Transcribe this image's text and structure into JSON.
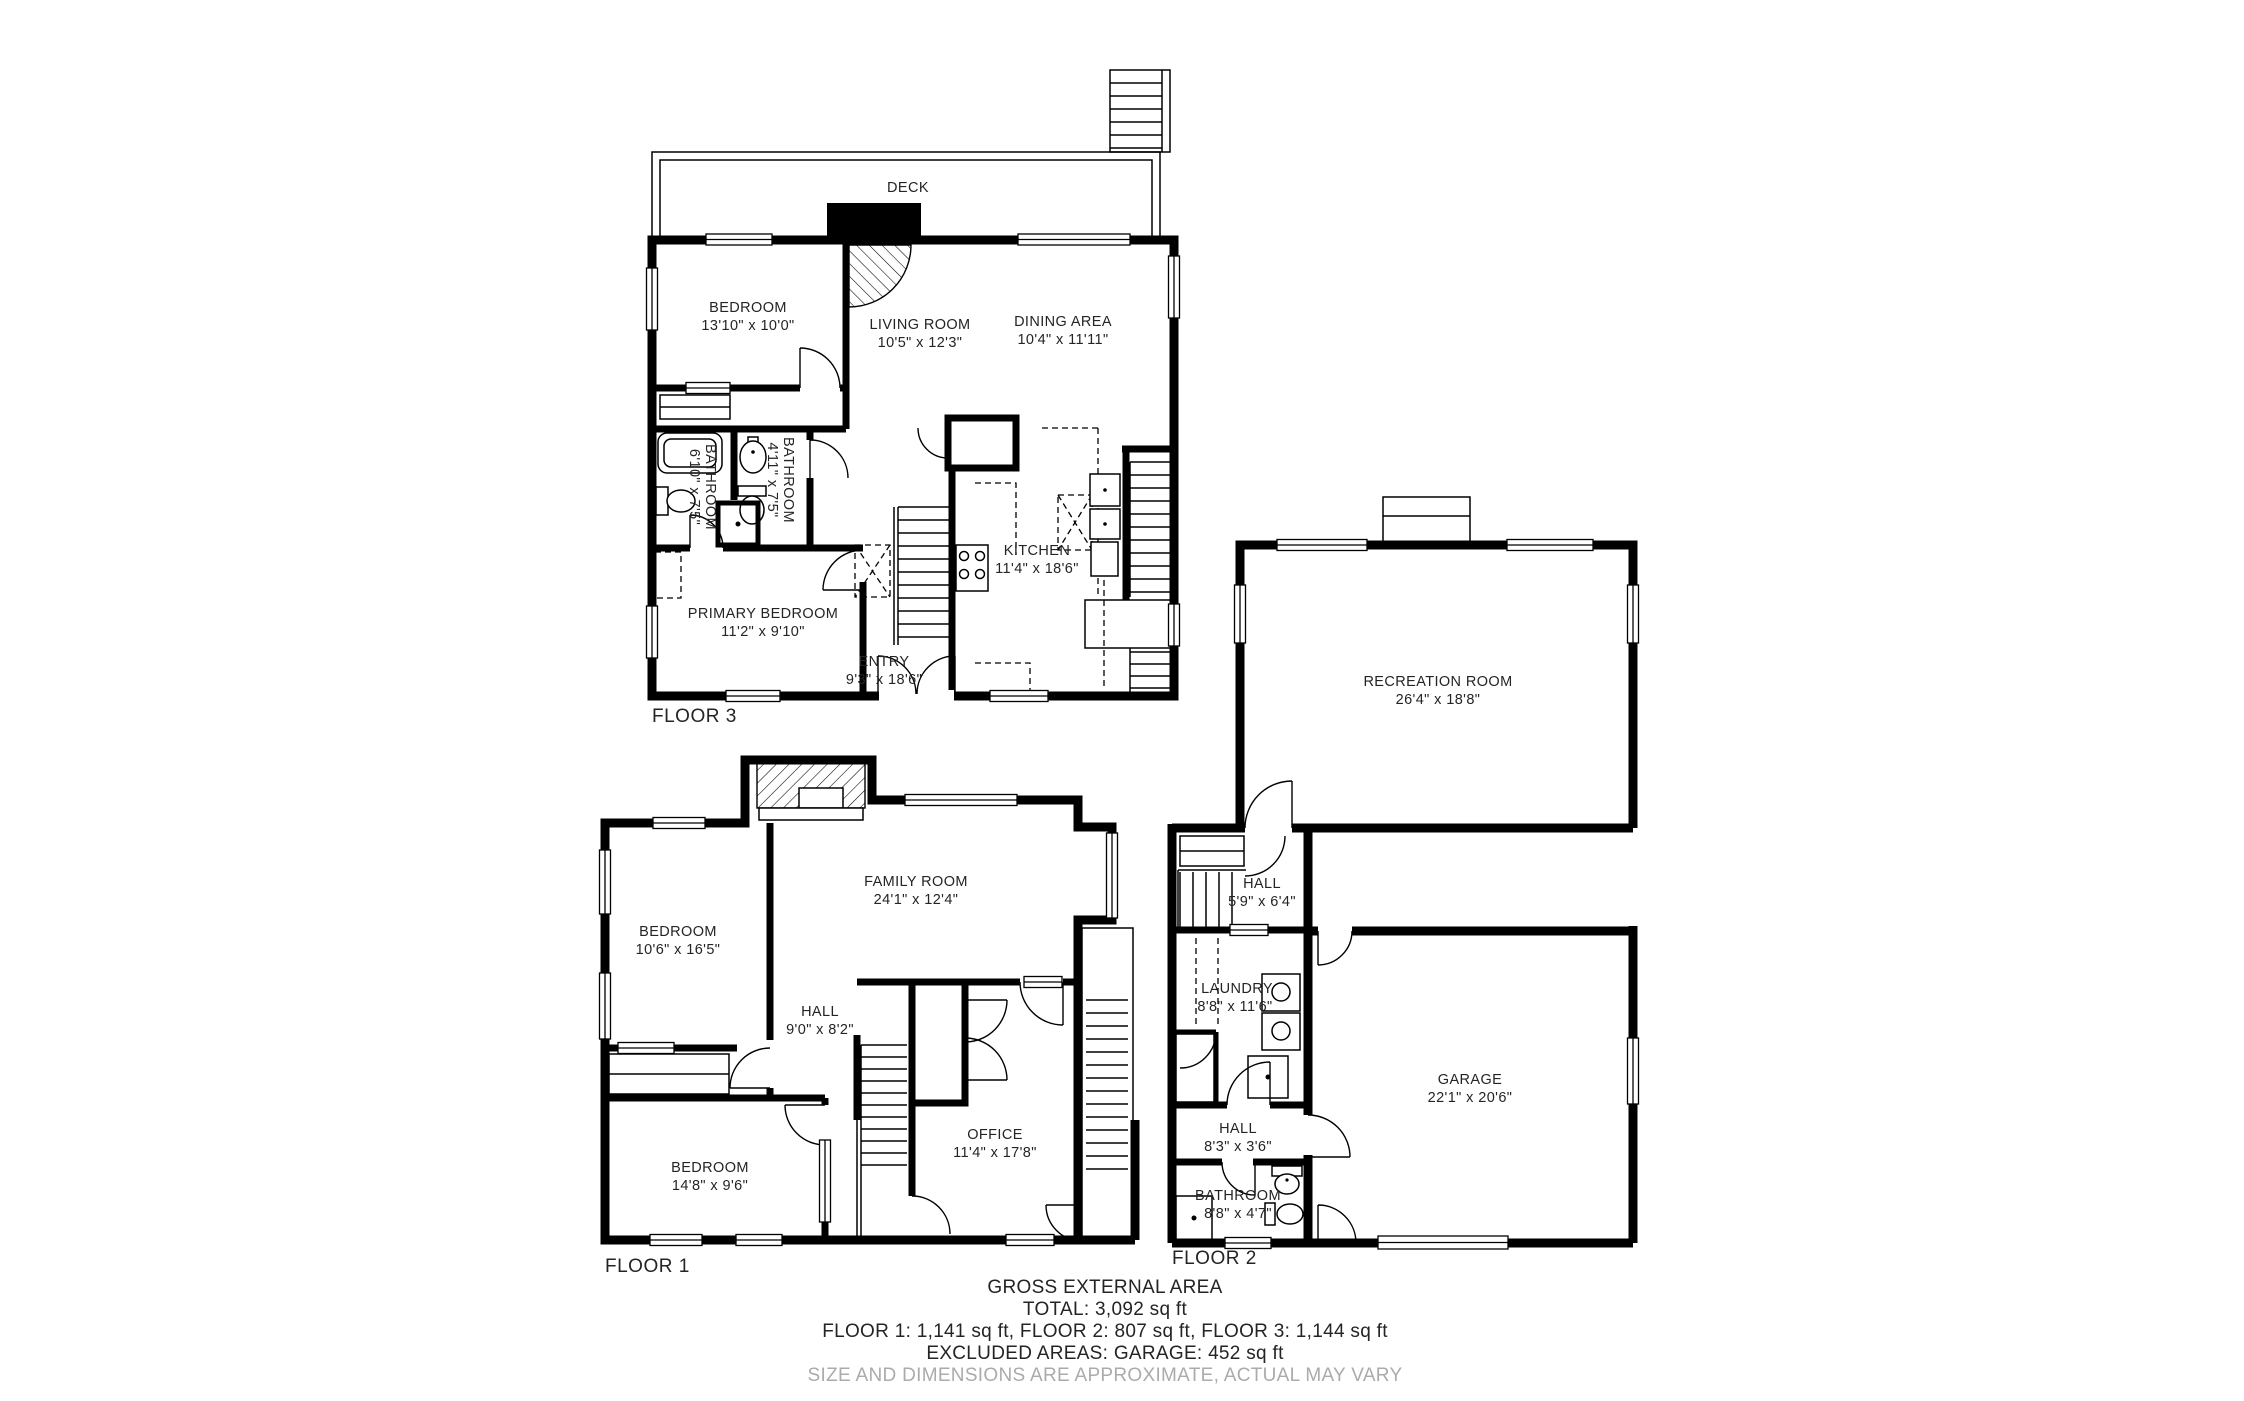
{
  "page_title": "Floor Plan",
  "colors": {
    "wall": "#000000",
    "text": "#242424",
    "muted": "#a9abad"
  },
  "floors": [
    {
      "label": "FLOOR 1",
      "rooms": [
        {
          "name": "BEDROOM",
          "dims": "10'6\" x 16'5\""
        },
        {
          "name": "FAMILY ROOM",
          "dims": "24'1\" x 12'4\""
        },
        {
          "name": "HALL",
          "dims": "9'0\" x 8'2\""
        },
        {
          "name": "OFFICE",
          "dims": "11'4\" x 17'8\""
        },
        {
          "name": "BEDROOM",
          "dims": "14'8\" x 9'6\""
        }
      ]
    },
    {
      "label": "FLOOR 2",
      "rooms": [
        {
          "name": "RECREATION ROOM",
          "dims": "26'4\" x 18'8\""
        },
        {
          "name": "HALL",
          "dims": "5'9\" x 6'4\""
        },
        {
          "name": "LAUNDRY",
          "dims": "8'8\" x 11'6\""
        },
        {
          "name": "GARAGE",
          "dims": "22'1\" x 20'6\""
        },
        {
          "name": "HALL",
          "dims": "8'3\" x 3'6\""
        },
        {
          "name": "BATHROOM",
          "dims": "8'8\" x 4'7\""
        }
      ]
    },
    {
      "label": "FLOOR 3",
      "deck_label": "DECK",
      "rooms": [
        {
          "name": "BEDROOM",
          "dims": "13'10\" x 10'0\""
        },
        {
          "name": "LIVING ROOM",
          "dims": "10'5\" x 12'3\""
        },
        {
          "name": "DINING AREA",
          "dims": "10'4\" x 11'11\""
        },
        {
          "name": "BATHROOM",
          "dims": "6'10\" x 7'5\""
        },
        {
          "name": "BATHROOM",
          "dims": "4'11\" x 7'5\""
        },
        {
          "name": "PRIMARY BEDROOM",
          "dims": "11'2\" x 9'10\""
        },
        {
          "name": "ENTRY",
          "dims": "9'3\" x 18'6\""
        },
        {
          "name": "KITCHEN",
          "dims": "11'4\" x 18'6\""
        }
      ]
    }
  ],
  "summary": {
    "heading": "GROSS EXTERNAL AREA",
    "total": "TOTAL: 3,092 sq ft",
    "floors_line": "FLOOR 1: 1,141 sq ft, FLOOR 2: 807 sq ft, FLOOR 3: 1,144 sq ft",
    "excluded": "EXCLUDED AREAS: GARAGE: 452 sq ft",
    "disclaimer": "SIZE AND DIMENSIONS ARE APPROXIMATE, ACTUAL MAY VARY"
  }
}
